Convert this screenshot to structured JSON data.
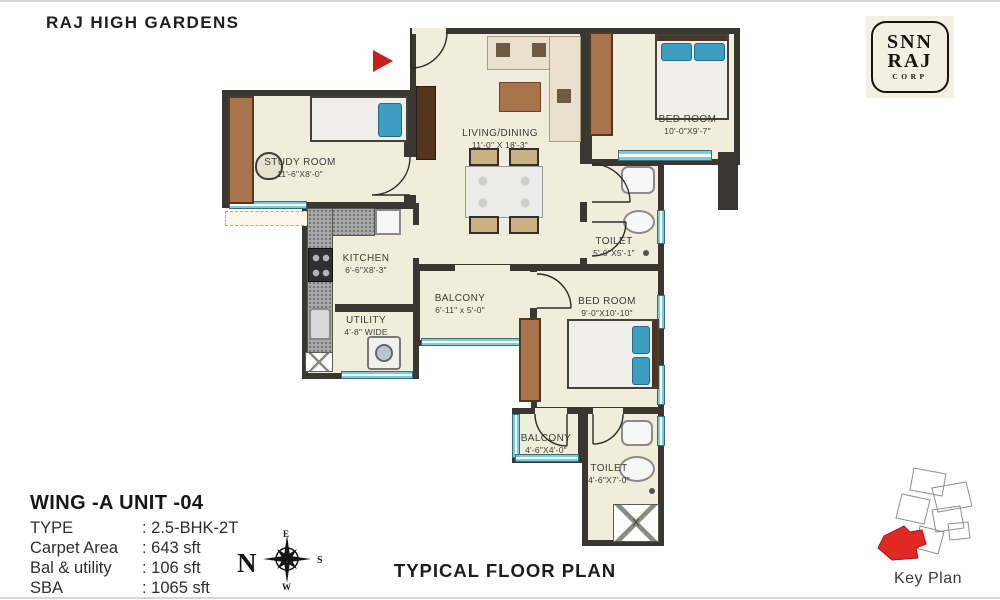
{
  "page": {
    "title": "RAJ HIGH GARDENS",
    "footer_title": "TYPICAL FLOOR PLAN"
  },
  "logo": {
    "line1": "SNN",
    "line2": "RAJ",
    "line3": "CORP"
  },
  "rooms": [
    {
      "id": "study-room",
      "name": "STUDY ROOM",
      "dims": "11'-6\"X8'-0\""
    },
    {
      "id": "living-dining",
      "name": "LIVING/DINING",
      "dims": "11'-0\" X 18'-3\""
    },
    {
      "id": "bedroom-1",
      "name": "BED ROOM",
      "dims": "10'-0\"X9'-7\""
    },
    {
      "id": "toilet-1",
      "name": "TOILET",
      "dims": "5'-0\"X5'-1\""
    },
    {
      "id": "kitchen",
      "name": "KITCHEN",
      "dims": "6'-6\"X8'-3\""
    },
    {
      "id": "utility",
      "name": "UTILITY",
      "dims": "4'-8\" WIDE"
    },
    {
      "id": "balcony-1",
      "name": "BALCONY",
      "dims": "6'-11\" x 5'-0\""
    },
    {
      "id": "bedroom-2",
      "name": "BED ROOM",
      "dims": "9'-0\"X10'-10\""
    },
    {
      "id": "balcony-2",
      "name": "BALCONY",
      "dims": "4'-6\"X4'-0\""
    },
    {
      "id": "toilet-2",
      "name": "TOILET",
      "dims": "4'-6\"X7'-0\""
    }
  ],
  "unit_info": {
    "heading": "WING -A  UNIT -04",
    "rows": [
      {
        "label": "TYPE",
        "value": ": 2.5-BHK-2T"
      },
      {
        "label": "Carpet Area",
        "value": ": 643 sft"
      },
      {
        "label": "Bal & utility",
        "value": ": 106 sft"
      },
      {
        "label": "SBA",
        "value": ": 1065 sft"
      }
    ]
  },
  "compass": {
    "n": "N",
    "e": "E",
    "s": "S",
    "w": "W"
  },
  "key_plan": {
    "label": "Key Plan"
  },
  "shaft_label": "X",
  "colors": {
    "wall": "#3a3632",
    "floor": "#f2ecdb",
    "window_glass": "#79ccd8",
    "bed_blue": "#3d9ec2",
    "wood_brown": "#a9744c",
    "entry_arrow_red": "#c5201d",
    "keyplan_highlight_red": "#e12822"
  }
}
